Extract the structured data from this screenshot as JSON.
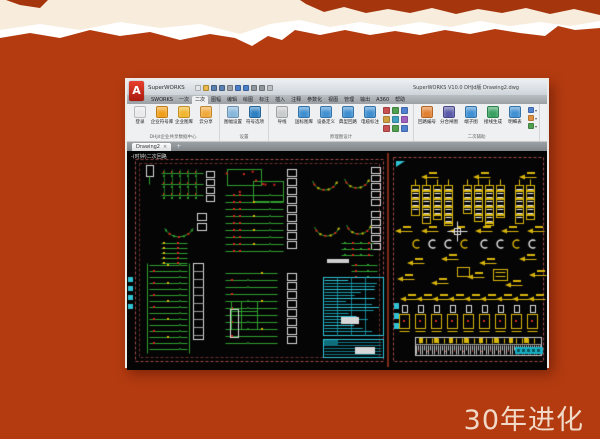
{
  "slide": {
    "caption": "30年进化"
  },
  "colors": {
    "background": "#b43b10",
    "torn_dark": "#a5350c",
    "cream": "#f8ecdc",
    "torn_white": "#ffffff",
    "caption": "#f0d9c7",
    "window": {
      "border": "#edebe7",
      "titlebar_top": "#eceff2",
      "titlebar_bottom": "#cdd4d9",
      "tabrow_top": "#b9bec2",
      "tabrow_bottom": "#9aa0a4",
      "ribbon": "#eef0f1",
      "filetab_bar_top": "#9ba1a5",
      "filetab_bar_bottom": "#7e8488",
      "canvas_bg": "#050505"
    },
    "cad": {
      "green": "#2f9e2f",
      "dark_green": "#1d6b1d",
      "red": "#d4281e",
      "yellow": "#d9b50a",
      "cyan": "#2fc2d4",
      "white": "#d8d8d8",
      "frame": "#a04848",
      "frame_inner": "#6b2f2f",
      "divider": "#7d2a16"
    }
  },
  "app": {
    "logo_letter": "A",
    "app_name": "SuperWORKS",
    "window_title": "SuperWORKS V10.0 DHJd版   Drawing2.dwg",
    "quick_access": [
      {
        "name": "new-file-icon",
        "color": "#e4e6e8"
      },
      {
        "name": "open-folder-icon",
        "color": "#e8b84a"
      },
      {
        "name": "save-icon",
        "color": "#5b7fae"
      },
      {
        "name": "save-as-icon",
        "color": "#5b7fae"
      },
      {
        "name": "plot-icon",
        "color": "#9aa2a8"
      },
      {
        "name": "undo-icon",
        "color": "#4a7ec8"
      },
      {
        "name": "redo-icon",
        "color": "#4a7ec8"
      },
      {
        "name": "refresh-icon",
        "color": "#8f979c"
      },
      {
        "name": "search-icon",
        "color": "#8f979c"
      },
      {
        "name": "dropdown-icon",
        "color": "#b8bec2"
      }
    ],
    "ribbon_tabs": [
      {
        "label": "SWORKS"
      },
      {
        "label": "一次"
      },
      {
        "label": "二次",
        "active": true
      },
      {
        "label": "图幅"
      },
      {
        "label": "编辑"
      },
      {
        "label": "绘图"
      },
      {
        "label": "标注"
      },
      {
        "label": "插入"
      },
      {
        "label": "注释"
      },
      {
        "label": "参数化"
      },
      {
        "label": "视图"
      },
      {
        "label": "管理"
      },
      {
        "label": "输出"
      },
      {
        "label": "A360"
      },
      {
        "label": "帮助"
      }
    ],
    "ribbon_groups": [
      {
        "label": "DHJd企业共享数据中心",
        "buttons": [
          {
            "label": "登录",
            "icon": "user-card-icon",
            "color": "#e9e9ea"
          },
          {
            "label": "企业符号库",
            "icon": "compass-icon",
            "color": "#f09f1c"
          },
          {
            "label": "企业图库",
            "icon": "folder-icon",
            "color": "#f2b52e"
          },
          {
            "label": "云分享",
            "icon": "cloud-share-icon",
            "color": "#f0a93c"
          }
        ]
      },
      {
        "label": "设置",
        "buttons": [
          {
            "label": "图幅设置",
            "icon": "sheet-settings-icon",
            "color": "#86b6da"
          },
          {
            "label": "符号选项",
            "icon": "globe-icon",
            "color": "#2e80c2"
          }
        ]
      },
      {
        "label": "原理图设计",
        "buttons": [
          {
            "label": "导线",
            "icon": "polyline-icon",
            "color": "#c9ccce"
          },
          {
            "label": "国标图库",
            "icon": "pencil-box-icon",
            "color": "#3f8fd0"
          },
          {
            "label": "设备定义",
            "icon": "device-grid-icon",
            "color": "#4090d2"
          },
          {
            "label": "典型回路",
            "icon": "circuit-icon",
            "color": "#3f8fd0"
          },
          {
            "label": "电缆标注",
            "icon": "cable-tag-icon",
            "color": "#3f8fd0"
          }
        ],
        "mini_icons": [
          {
            "name": "text-tool-icon",
            "color": "#c85050"
          },
          {
            "name": "table-tool-icon",
            "color": "#50a050"
          },
          {
            "name": "edit-tool-icon",
            "color": "#5080d0"
          },
          {
            "name": "align-tool-icon",
            "color": "#d0a040"
          },
          {
            "name": "copy-tool-icon",
            "color": "#40a0c0"
          },
          {
            "name": "erase-tool-icon",
            "color": "#a060c0"
          },
          {
            "name": "layer-tool-icon",
            "color": "#c85050"
          },
          {
            "name": "match-tool-icon",
            "color": "#50a050"
          },
          {
            "name": "measure-tool-icon",
            "color": "#5080d0"
          }
        ]
      },
      {
        "label": "二次辅助",
        "buttons": [
          {
            "label": "回路编号",
            "icon": "numbering-icon",
            "color": "#e08030"
          },
          {
            "label": "分合闸图",
            "icon": "org-tree-icon",
            "color": "#5a5aa8"
          },
          {
            "label": "端子图",
            "icon": "terminal-grid-icon",
            "color": "#4090d2"
          },
          {
            "label": "接线生成",
            "icon": "wiring-icon",
            "color": "#38a060"
          },
          {
            "label": "明细表",
            "icon": "detail-table-icon",
            "color": "#4090d2"
          }
        ],
        "stack_icons": [
          {
            "name": "list-mini-icon",
            "color": "#5080d0"
          },
          {
            "name": "export-mini-icon",
            "color": "#e09040"
          },
          {
            "name": "check-mini-icon",
            "color": "#50a050"
          }
        ]
      }
    ],
    "file_tab": {
      "label": "Drawing2",
      "close_glyph": "×"
    },
    "new_tab_glyph": "+",
    "canvas_note": "-(时钟)二次回路"
  }
}
